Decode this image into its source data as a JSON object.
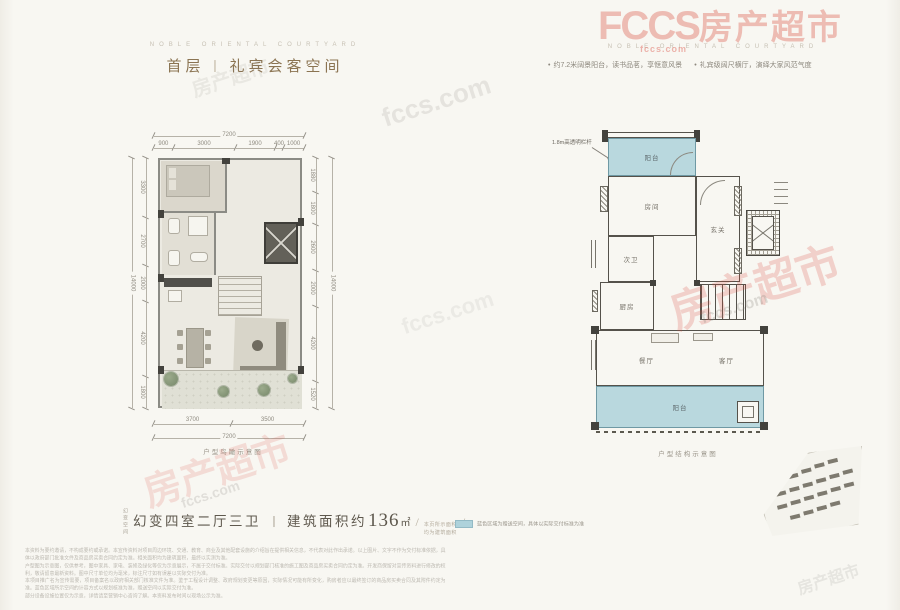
{
  "header_left": {
    "eyebrow": "NOBLE ORIENTAL COURTYARD",
    "title_prefix": "首层",
    "title_divider": "丨",
    "title_suffix": "礼宾会客空间"
  },
  "header_right": {
    "eyebrow": "NOBLE ORIENTAL COURTYARD",
    "bullet1": "约7.2米阔景阳台，读书品茗，享惬意风景",
    "bullet2": "礼宾级阔尺横厅，演绎大家风范气度"
  },
  "left_plan": {
    "caption": "户型鸟瞰示意图",
    "dims": {
      "top_total": "7200",
      "top": [
        "900",
        "3000",
        "1900",
        "400",
        "1000"
      ],
      "left_total": "14000",
      "left": [
        "3300",
        "2700",
        "2000",
        "4200",
        "1800"
      ],
      "right_total": "14000",
      "right": [
        "1880",
        "1800",
        "2600",
        "2000",
        "4200",
        "1520"
      ],
      "bottom_total": "7200",
      "bottom": [
        "3700",
        "3500"
      ]
    }
  },
  "right_plan": {
    "caption": "户型结构示意图",
    "annotation": "1.8m高透明栏杆",
    "rooms": {
      "balcony_top": "阳台",
      "bedroom": "房间",
      "bath": "次卫",
      "foyer": "玄关",
      "kitchen": "厨房",
      "dining": "餐厅",
      "living": "客厅",
      "balcony_bottom": "阳台"
    }
  },
  "footer": {
    "unit_title": "幻变四室二厅三卫",
    "divider": "丨",
    "area_prefix": "建筑面积约",
    "area_value": "136",
    "area_unit": "㎡",
    "slash1": "/",
    "slash2": "/",
    "area_note_line1": "本页所示面积",
    "area_note_line2": "均为建筑面积",
    "micro_vertical": "幻变空间",
    "legend_text": "蓝色区域为赠送空间，具体以实际交付标准为准",
    "disclaimer": [
      "本资料为要约邀请，不构成要约或承诺。本宣传资料对项目周边环境、交通、教育、商业及其他配套设施的介绍旨在提供相关信息，不代表对此作出承诺。以上图片、文字不作为交付标准依据，具体以政府部门批准文件及商品房买卖合同约定为准。相关面积均为建筑面积，最终以实测为准。",
      "户型图为示意图，仅供参考，图中家具、家电、装修及绿化等仅为示意展示，不属于交付标准。实际交付以规划部门核准的施工图及商品房买卖合同约定为准。开发商保留对宣传资料进行修改的权利，敬请留意最新资料。图中尺寸单位均为毫米，标注尺寸如有误差以实际交付为准。",
      "本项目推广名为宣传需要，项目备案名以政府相关部门核准文件为准。鉴于工程设计调整、政府规划变更等原因，实际情况可能有所变化，购房者应以最终签订的商品房买卖合同及其附件约定为准。蓝色区域所示空间的计容方式以规划核准为准，赠送空间以实际交付为准。",
      "部分设备设施位置仅为示意，详情请至营销中心咨询了解。本资料发布时间以现场公示为准。"
    ]
  },
  "watermark": {
    "brand": "FCCS",
    "brand_cn": "房产超市",
    "site": "fccs.com",
    "red": "#d9483c"
  }
}
